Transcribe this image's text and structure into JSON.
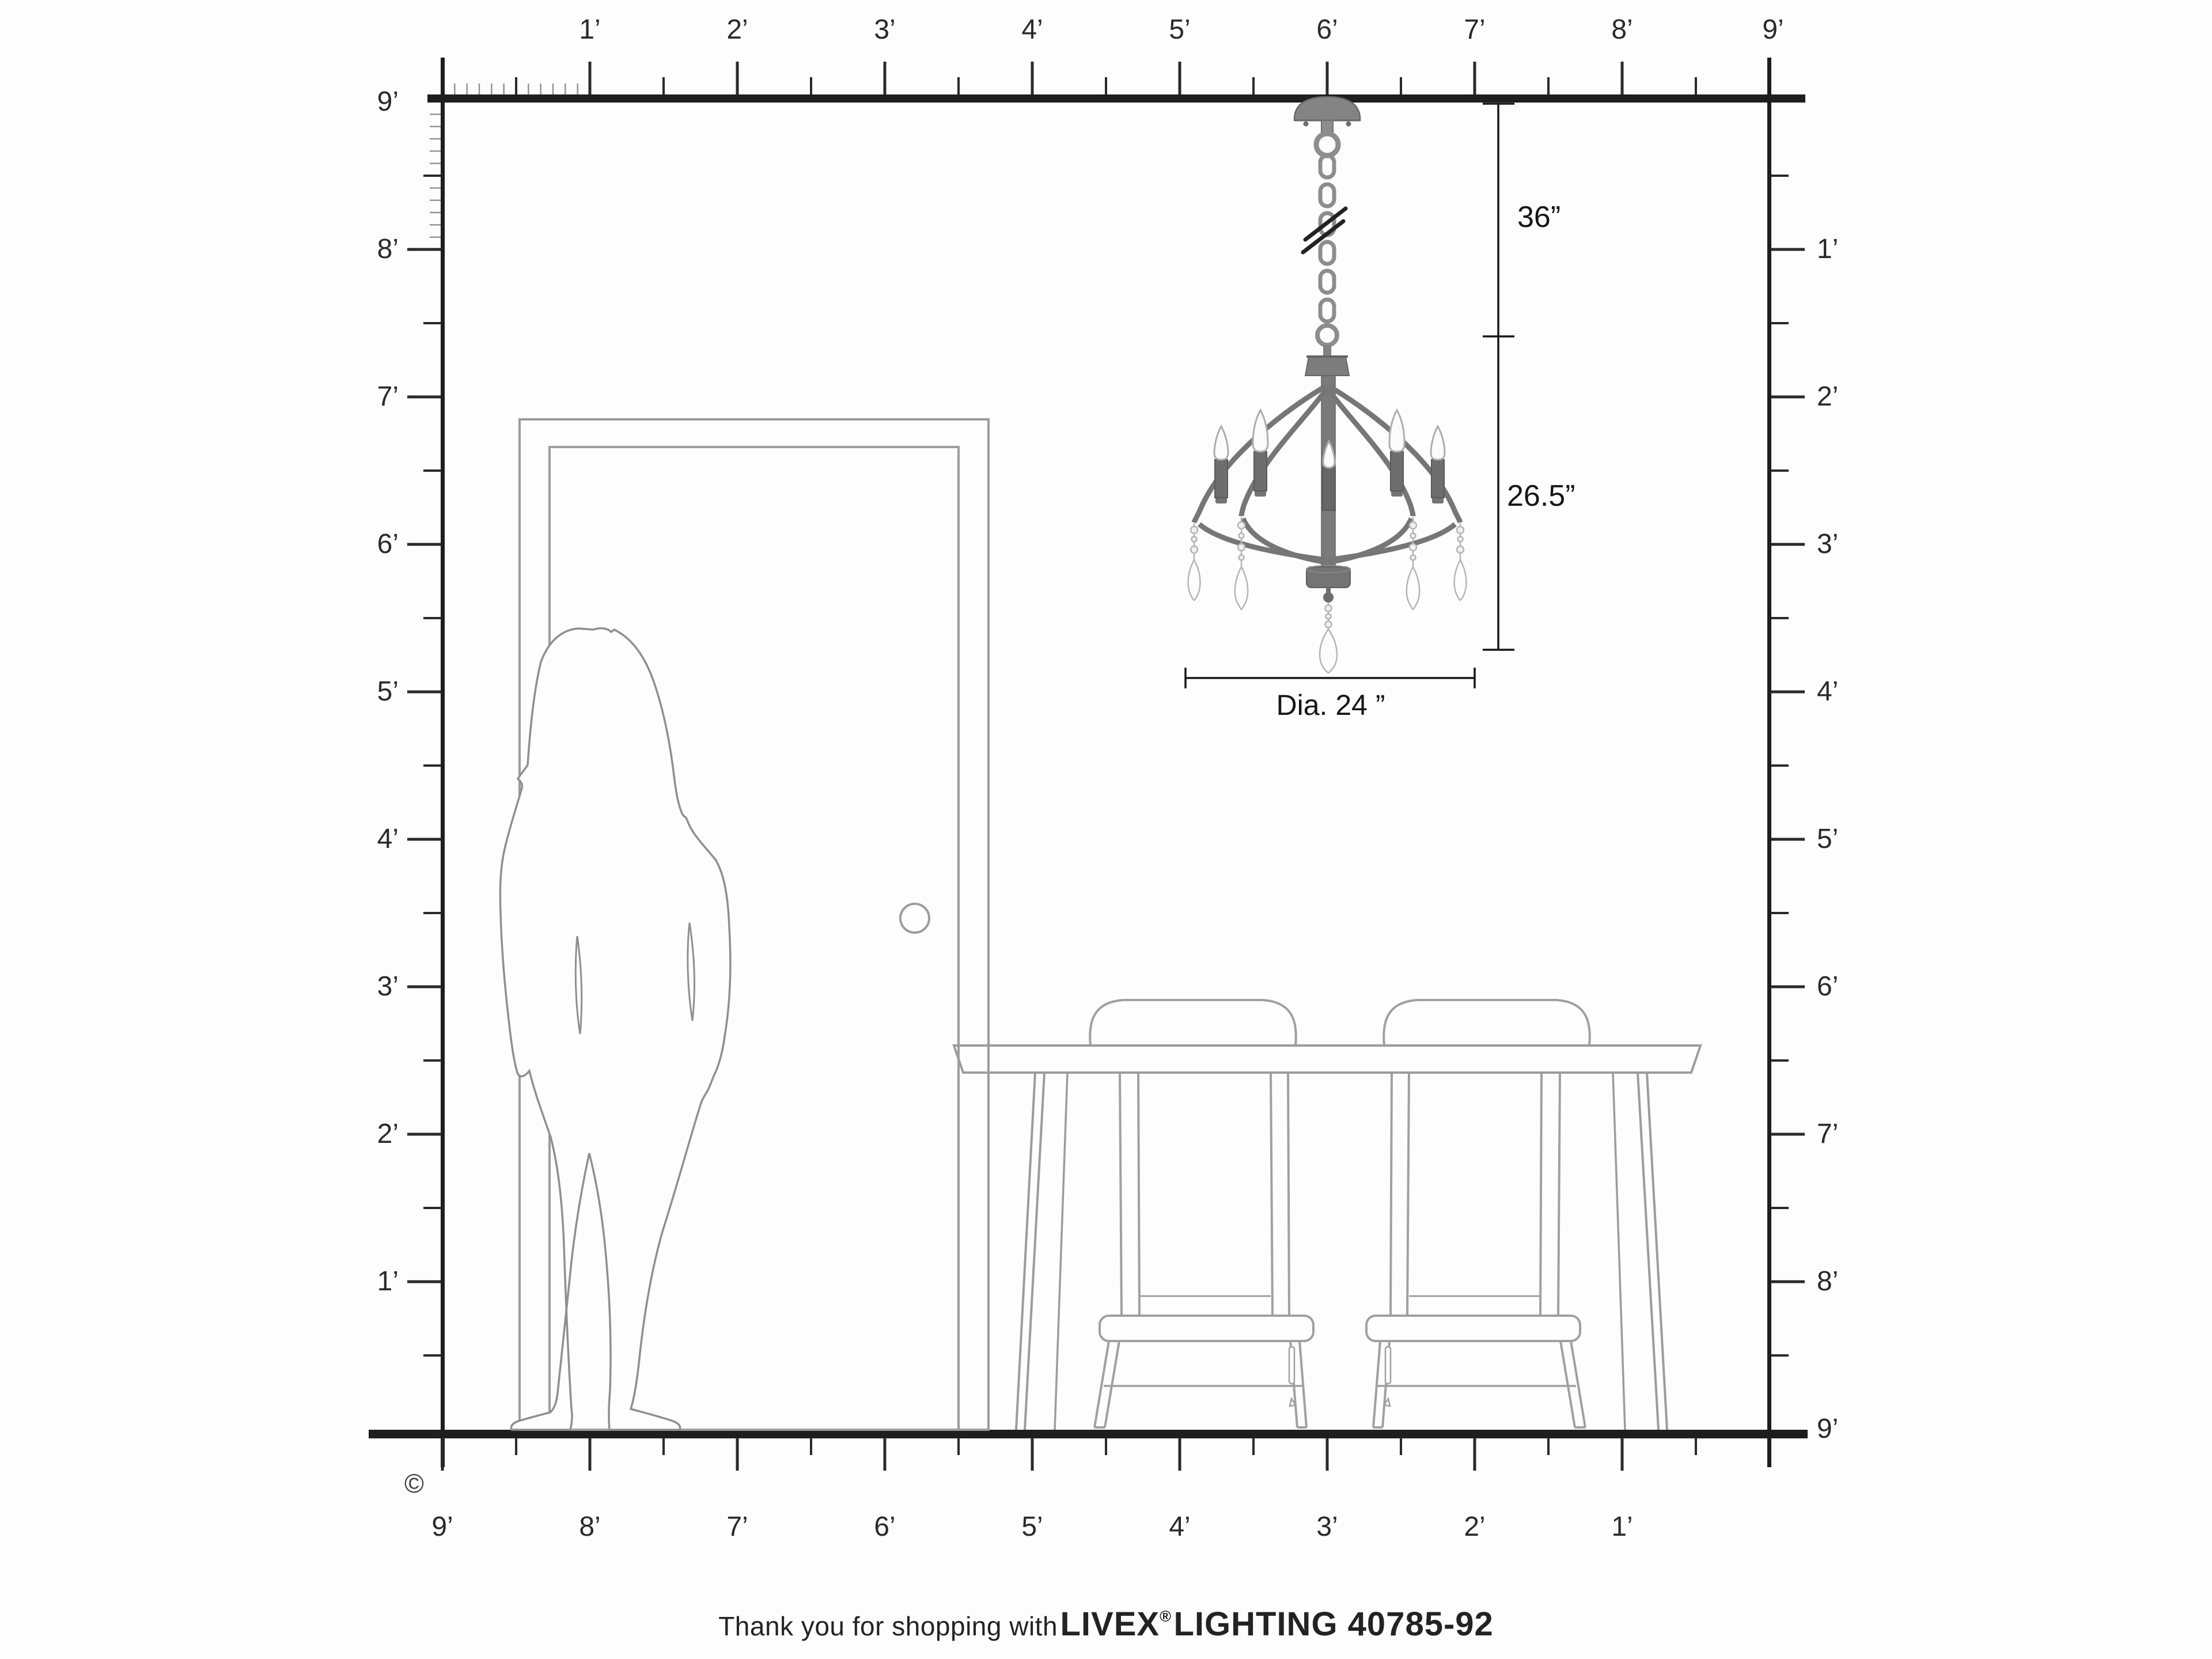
{
  "title": "Chandelier room scale diagram",
  "colors": {
    "wall_line": "#1e1e1e",
    "tick_black": "#2a2a2a",
    "tick_gray": "#909090",
    "furniture_outline": "#9c9c9c",
    "silhouette_outline": "#8f8f8f",
    "metal_gray": "#7a7a7a",
    "crystal_outline": "#b8b8b8",
    "text_dark": "#232323"
  },
  "rulers": {
    "unit": "feet",
    "top": {
      "labels": [
        "1’",
        "2’",
        "3’",
        "4’",
        "5’",
        "6’",
        "7’",
        "8’",
        "9’"
      ]
    },
    "left": {
      "labels": [
        "9’",
        "8’",
        "7’",
        "6’",
        "5’",
        "4’",
        "3’",
        "2’",
        "1’"
      ]
    },
    "right": {
      "labels": [
        "1’",
        "2’",
        "3’",
        "4’",
        "5’",
        "6’",
        "7’",
        "8’",
        "9’"
      ]
    },
    "bottom": {
      "labels": [
        "9’",
        "8’",
        "7’",
        "6’",
        "5’",
        "4’",
        "3’",
        "2’",
        "1’"
      ]
    }
  },
  "dimensions": {
    "chain_length": "36”",
    "fixture_height": "26.5”",
    "diameter": "Dia. 24 ”"
  },
  "scene": {
    "items": [
      "door",
      "door-knob",
      "woman-silhouette",
      "dining-table",
      "chair",
      "chair",
      "chandelier",
      "crystal-drops",
      "chain-break"
    ]
  },
  "copyright_symbol": "©",
  "footer": {
    "prefix": "Thank you for shopping with",
    "brand": "LIVEX",
    "registered": "®",
    "product": "LIGHTING 40785-92"
  }
}
